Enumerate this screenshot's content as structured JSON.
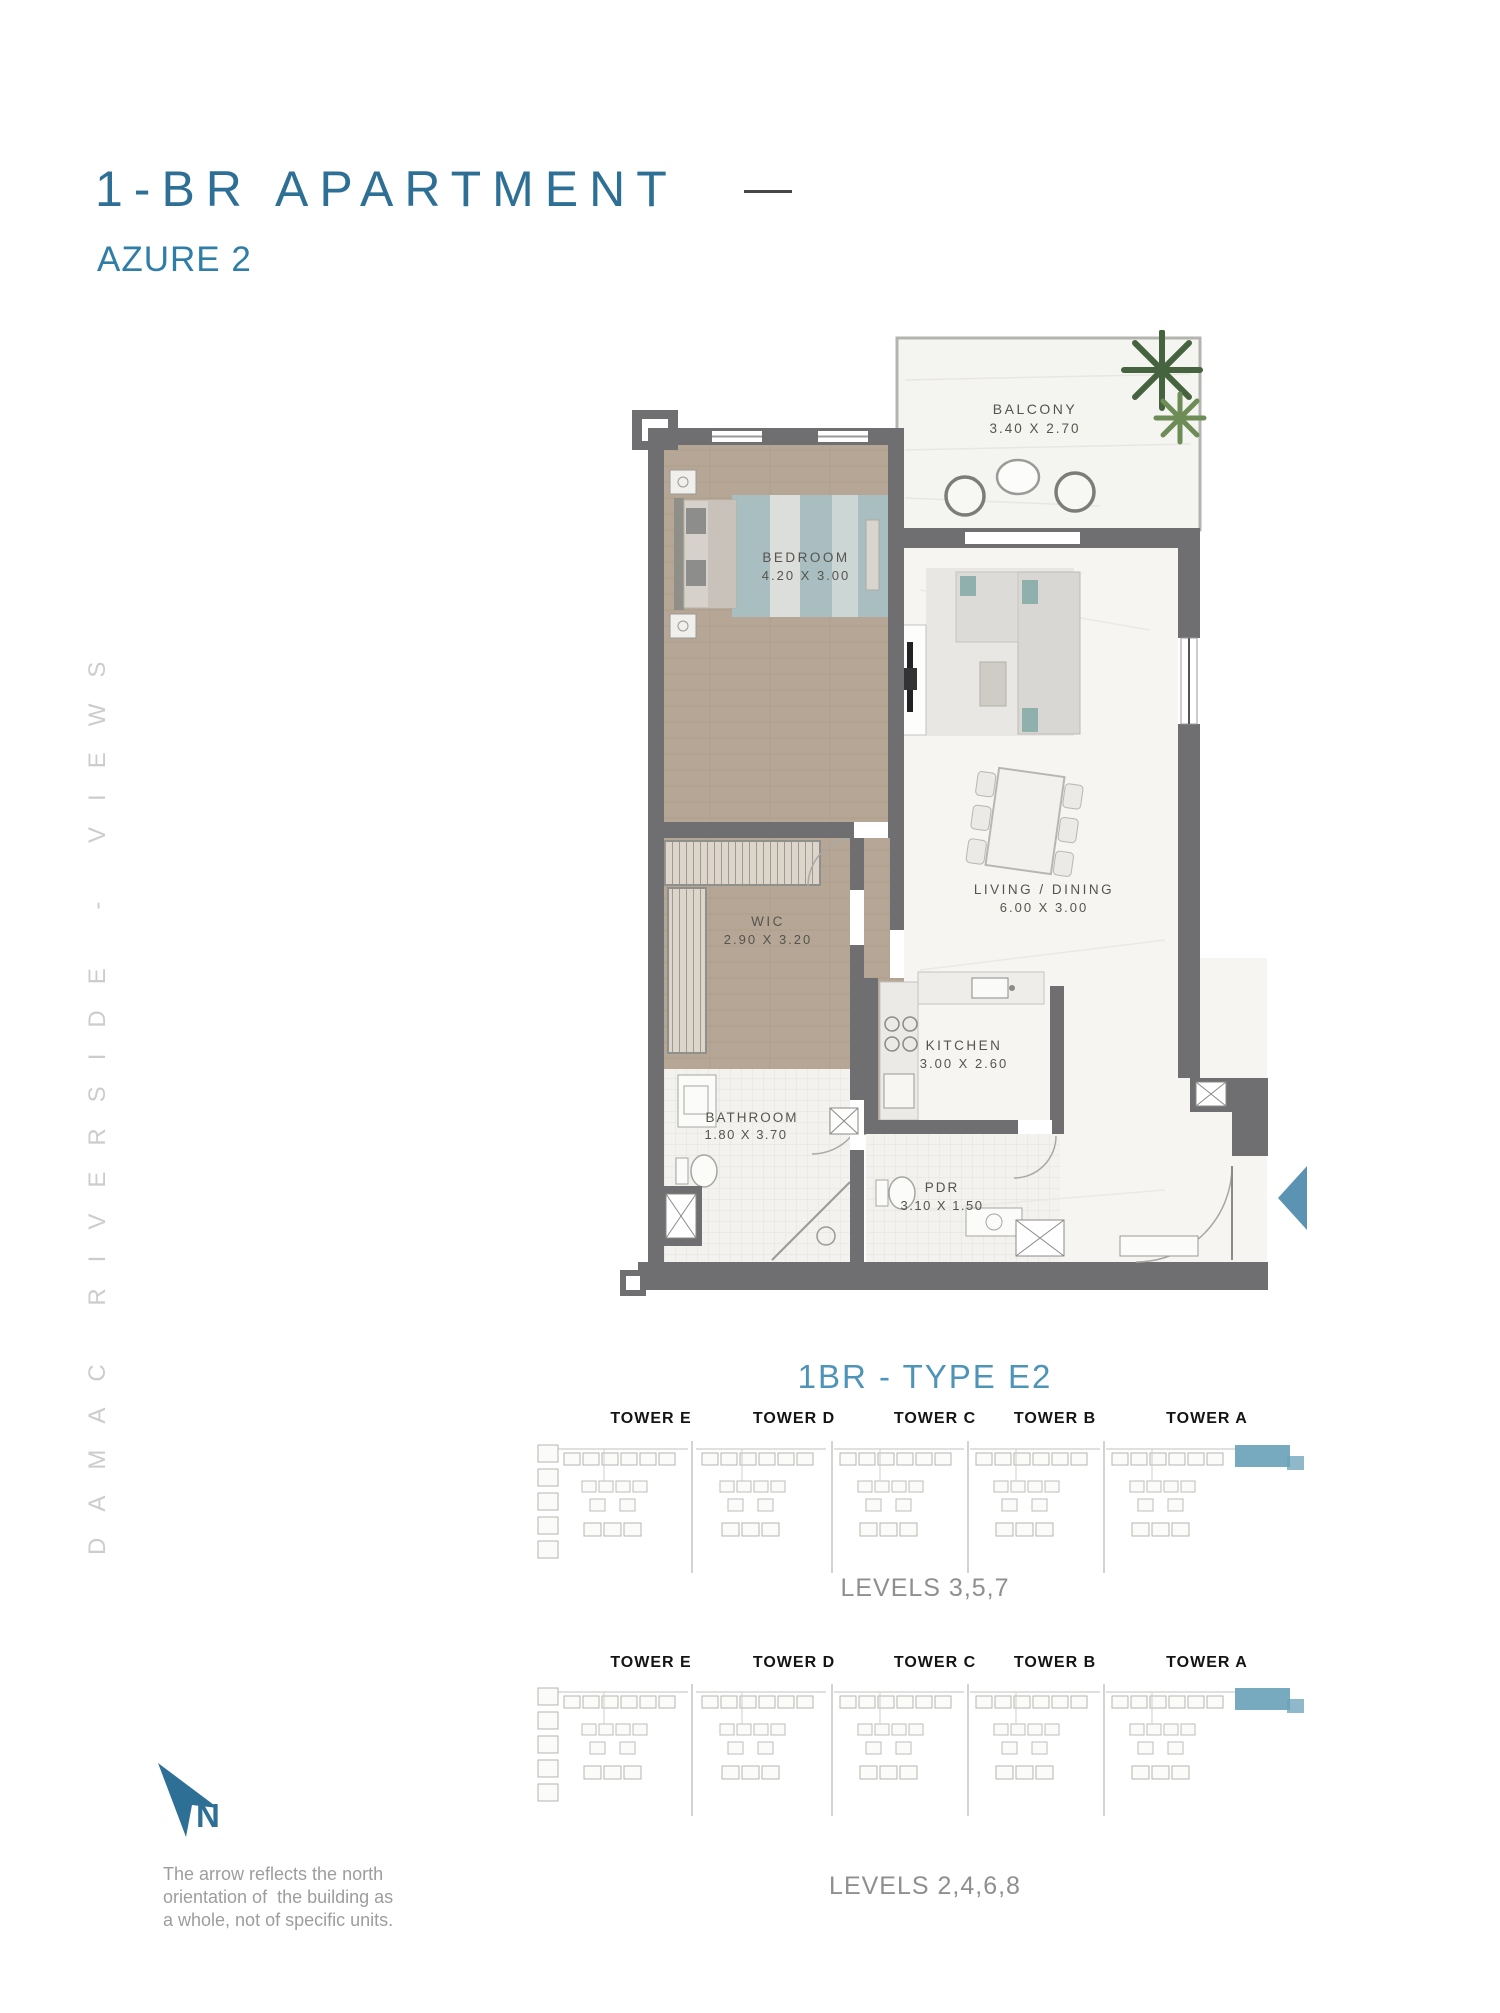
{
  "page": {
    "title": "1-BR APARTMENT",
    "subtitle": "AZURE 2",
    "side_text": "DAMAC RIVERSIDE - VIEWS"
  },
  "floorplan": {
    "rooms": {
      "balcony": {
        "name": "BALCONY",
        "dims": "3.40 X 2.70"
      },
      "bedroom": {
        "name": "BEDROOM",
        "dims": "4.20 X 3.00"
      },
      "wic": {
        "name": "WIC",
        "dims": "2.90 X 3.20"
      },
      "living": {
        "name": "LIVING / DINING",
        "dims": "6.00 X 3.00"
      },
      "kitchen": {
        "name": "KITCHEN",
        "dims": "3.00 X 2.60"
      },
      "bathroom": {
        "name": "BATHROOM",
        "dims": "1.80 X 3.70"
      },
      "pdr": {
        "name": "PDR",
        "dims": "3.10 X 1.50"
      }
    }
  },
  "unit": {
    "heading": "1BR - TYPE E2"
  },
  "diagrams": [
    {
      "towers": [
        "TOWER E",
        "TOWER D",
        "TOWER C",
        "TOWER B",
        "TOWER A"
      ],
      "levels": "LEVELS 3,5,7"
    },
    {
      "towers": [
        "TOWER E",
        "TOWER D",
        "TOWER C",
        "TOWER B",
        "TOWER A"
      ],
      "levels": "LEVELS 2,4,6,8"
    }
  ],
  "north": {
    "label": "N",
    "note": "The arrow reflects the north\norientation of  the building as\na whole, not of specific units."
  },
  "colors": {
    "accent": "#2e6f96",
    "subtitle": "#2f7ea8",
    "unit_heading": "#4e93b8",
    "levels_text": "#8f8f8f",
    "walls": "#6f6f71",
    "wood_floor": "#b6a695",
    "rug_teal": "#a9bec1",
    "keyplan_highlight": "#69a1b8",
    "entry_arrow": "#5b94b2",
    "watermark": "#cccccc"
  }
}
